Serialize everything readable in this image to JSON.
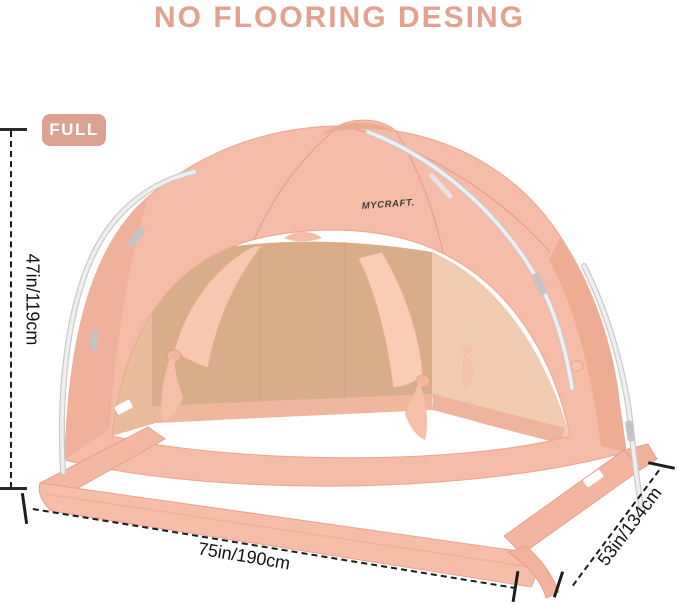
{
  "title": {
    "text": "NO FLOORING DESING",
    "color": "#e2a28f"
  },
  "badge": {
    "label": "FULL",
    "background": "#dca28f",
    "text_color": "#ffffff"
  },
  "tent": {
    "brand_label": "MYCRAFT.",
    "colors": {
      "canopy": "#f5bca7",
      "canopy_shade": "#eeac93",
      "interior_back_wall": "#d8ae8a",
      "interior_side_panel": "#f1cbb0",
      "base_skirt": "#f6bda7",
      "pole": "#efefef",
      "floor": "#ffffff"
    }
  },
  "dimensions": {
    "line_color": "#1c1c1c",
    "height": {
      "label": "47in/119cm"
    },
    "width": {
      "label": "75in/190cm"
    },
    "depth": {
      "label": "53in/134cm"
    }
  }
}
